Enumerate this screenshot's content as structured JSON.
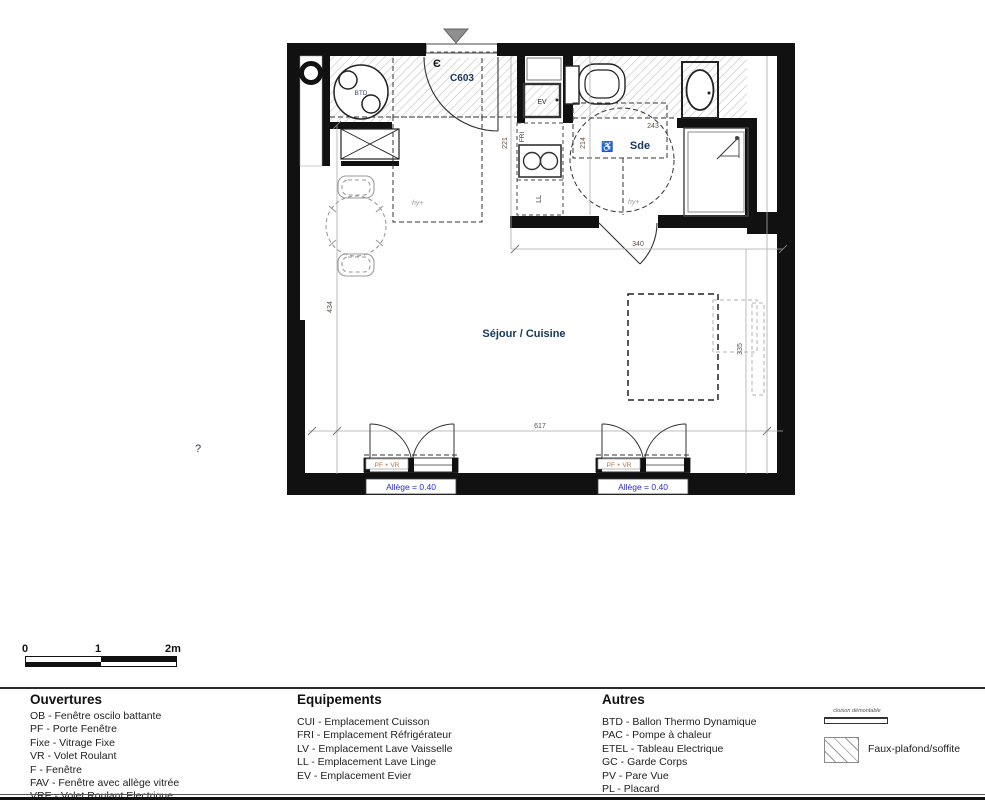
{
  "plan": {
    "unit": "C603",
    "entry_symbol": "Є",
    "rooms": {
      "sde": "Sde",
      "sejour": "Séjour / Cuisine"
    },
    "equipment_labels": {
      "btd": "BTD",
      "ev": "EV",
      "fri": "FRI",
      "ll": "LL"
    },
    "dimensions": {
      "d221": "221",
      "d214": "214",
      "d243": "243",
      "d340": "340",
      "d335": "335",
      "d434": "434",
      "d617": "617"
    },
    "annotations": {
      "hy_entry": "hy+",
      "hy_sde": "hy+",
      "wheelchair": "♿",
      "question_mark": "?"
    },
    "window_label": "PF + VR",
    "allege_label": "Allège = 0.40"
  },
  "scalebar": {
    "zero": "0",
    "one": "1",
    "two": "2m"
  },
  "legend": {
    "columns": [
      {
        "title": "Ouvertures",
        "items": [
          "OB - Fenêtre oscilo battante",
          "PF - Porte Fenêtre",
          "Fixe - Vitrage Fixe",
          "VR - Volet Roulant",
          "F - Fenêtre",
          "FAV - Fenêtre avec allège vitrée",
          "VRE - Volet Roulant Electrique"
        ]
      },
      {
        "title": "Equipements",
        "items": [
          "CUI - Emplacement Cuisson",
          "FRI - Emplacement Réfrigérateur",
          "LV - Emplacement Lave Vaisselle",
          "LL - Emplacement Lave Linge",
          "EV - Emplacement Evier"
        ]
      },
      {
        "title": "Autres",
        "items": [
          "BTD - Ballon Thermo Dynamique",
          "PAC - Pompe à chaleur",
          "ETEL - Tableau Electrique",
          "GC - Garde Corps",
          "PV - Pare Vue",
          "PL - Placard"
        ]
      }
    ],
    "symbols": {
      "cloison": "cloison démontable",
      "faux_plafond": "Faux-plafond/soffite"
    }
  },
  "colors": {
    "wall": "#111111",
    "label_navy": "#17365d",
    "allege_blue": "#2b2bd0",
    "window_orange": "#b5733d",
    "dim_brown": "#5f4f45"
  }
}
